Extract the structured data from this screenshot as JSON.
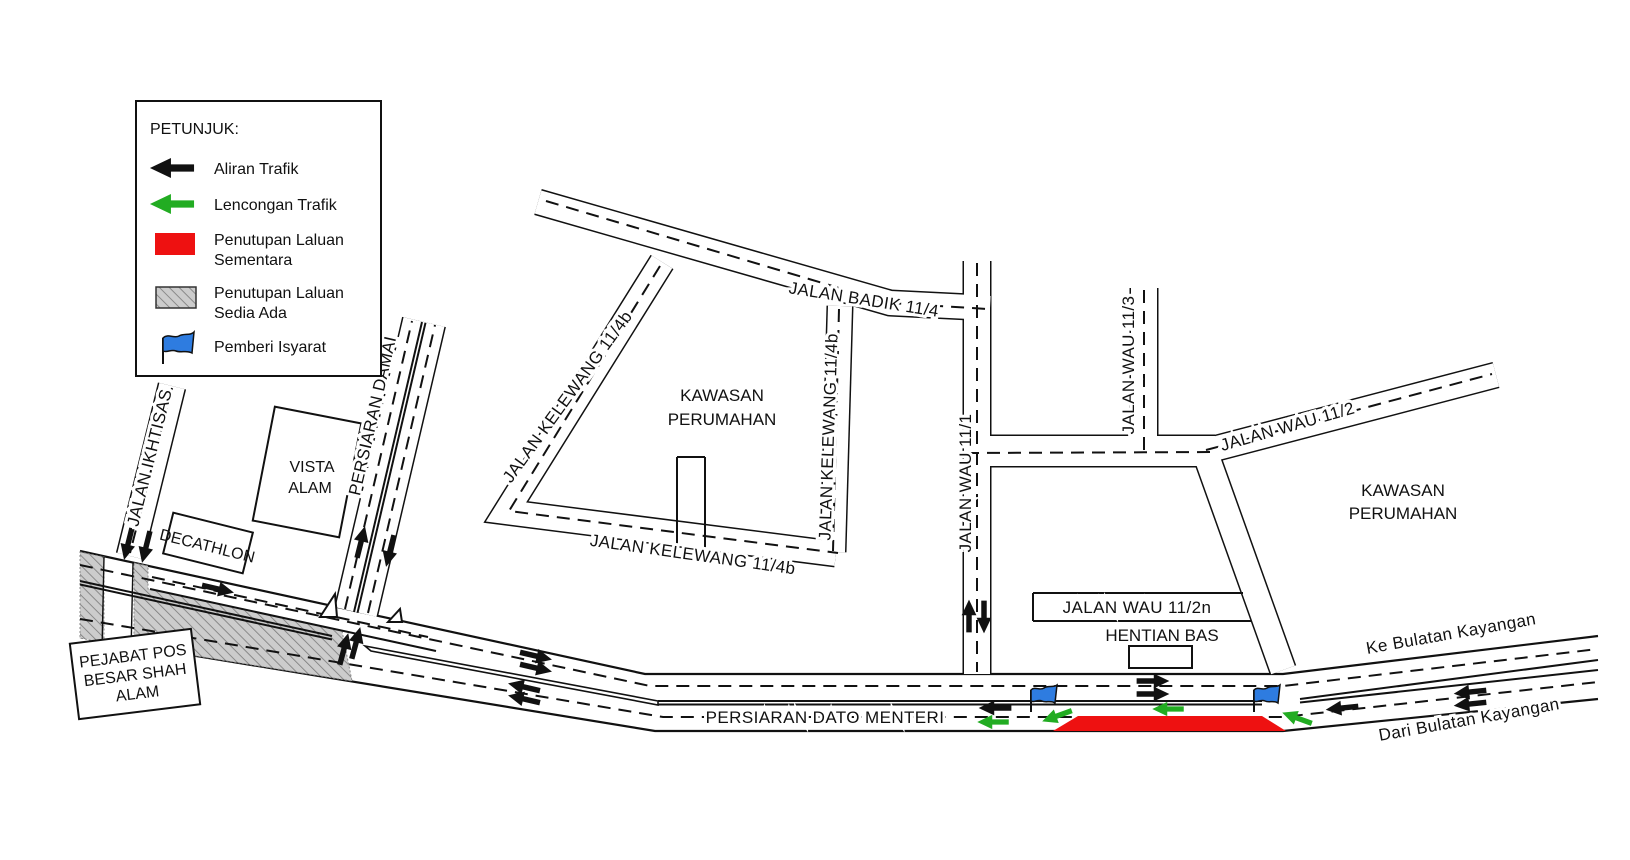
{
  "legend": {
    "title": "PETUNJUK:",
    "aliran": "Aliran Trafik",
    "lencongan": "Lencongan Trafik",
    "penutupan_sementara_1": "Penutupan Laluan",
    "penutupan_sementara_2": "Sementara",
    "penutupan_sedia_1": "Penutupan Laluan",
    "penutupan_sedia_2": "Sedia Ada",
    "pemberi": "Pemberi Isyarat"
  },
  "roads": {
    "badik": "JALAN BADIK 11/4",
    "kelewang_w": "JALAN KELEWANG 11/4b",
    "kelewang_s": "JALAN KELEWANG 11/4b",
    "kelewang_e": "JALAN KELEWANG 11/4b",
    "wau_11_1": "JALAN WAU 11/1",
    "wau_11_3": "JALAN WAU 11/3",
    "wau_11_2": "JALAN WAU 11/2",
    "wau_11_2n": "JALAN WAU 11/2n",
    "damai": "PERSIARAN DAMAI",
    "ikhtisas": "JALAN IKHTISAS",
    "dato_menteri": "PERSIARAN DATO MENTERI"
  },
  "places": {
    "kawasan_left_1": "KAWASAN",
    "kawasan_left_2": "PERUMAHAN",
    "kawasan_right_1": "KAWASAN",
    "kawasan_right_2": "PERUMAHAN",
    "vista_1": "VISTA",
    "vista_2": "ALAM",
    "decathlon": "DECATHLON",
    "pejabat_1": "PEJABAT POS",
    "pejabat_2": "BESAR SHAH",
    "pejabat_3": "ALAM",
    "hentian": "HENTIAN BAS"
  },
  "directions": {
    "ke_bulatan": "Ke Bulatan Kayangan",
    "dari_bulatan": "Dari Bulatan Kayangan"
  },
  "colors": {
    "traffic_flow": "#111111",
    "diversion": "#22ac22",
    "closure_temp": "#ee1111",
    "closure_existing_fill": "#cccccc",
    "flag_blue": "#2e7ce0"
  }
}
